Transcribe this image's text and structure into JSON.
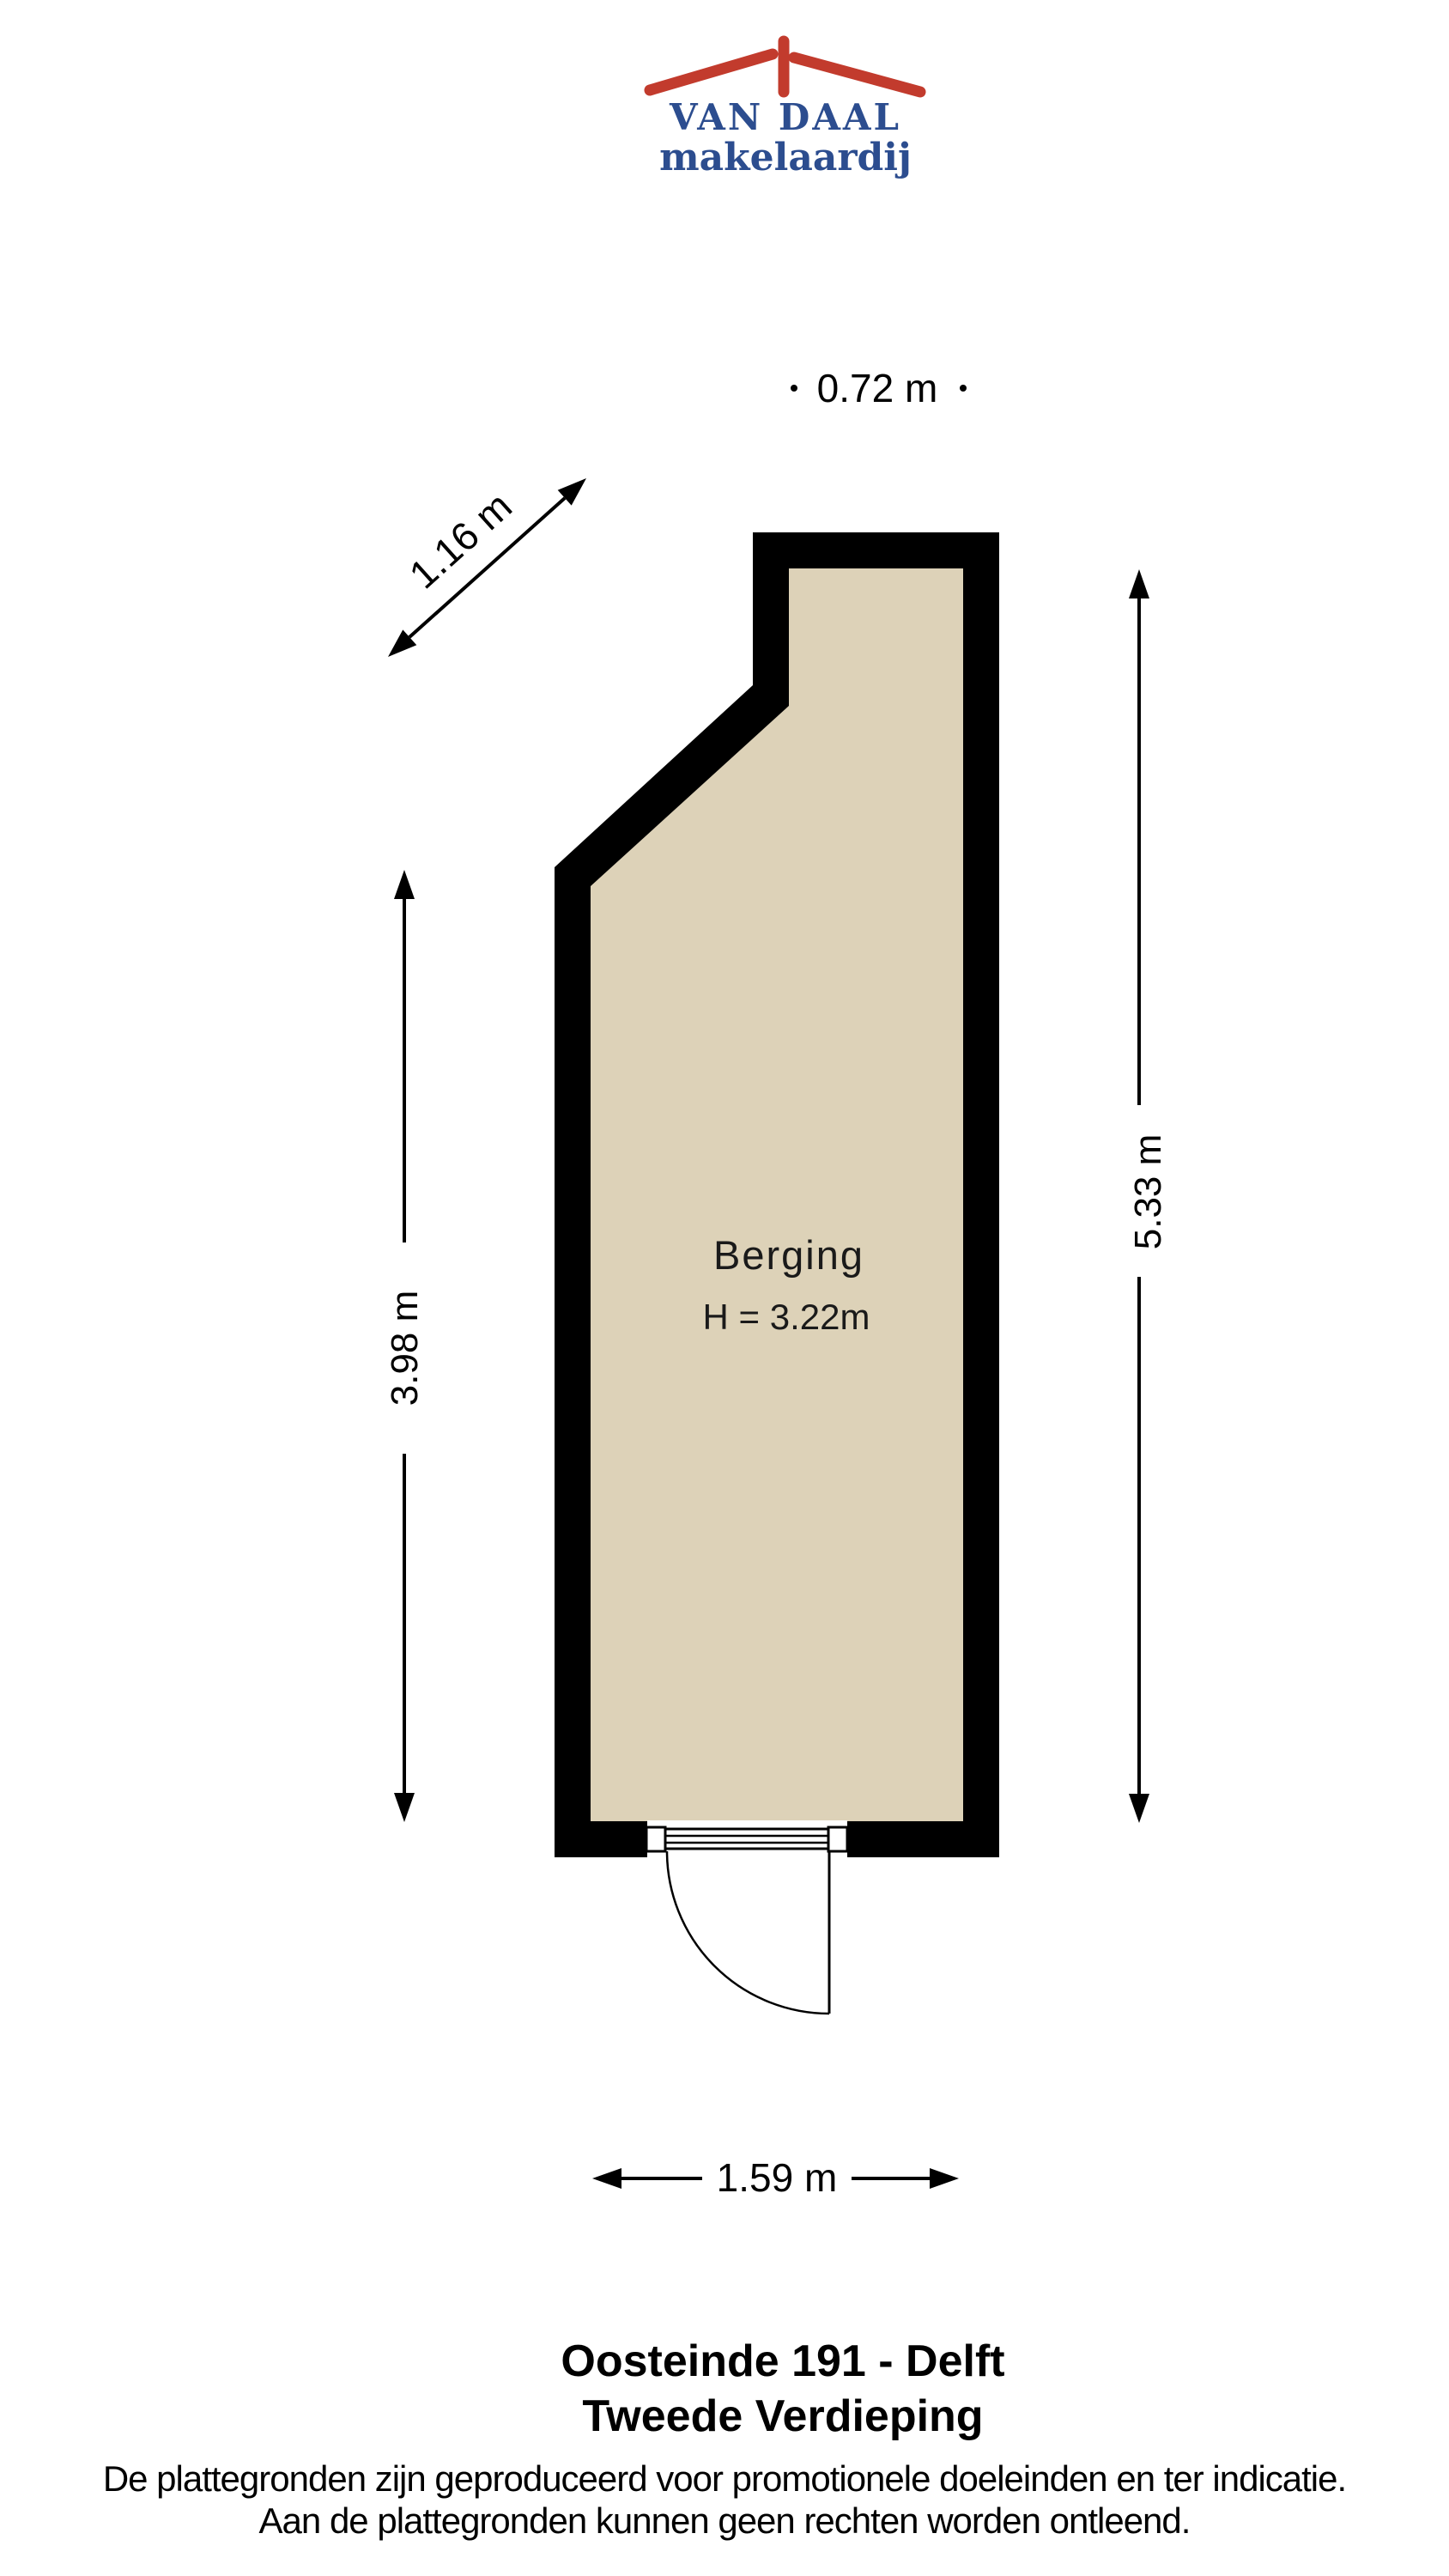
{
  "logo": {
    "brand": "VAN DAAL",
    "subtitle": "makelaardij",
    "roof_color": "#c23b2d",
    "text_color": "#2c4d8f"
  },
  "plan": {
    "room": {
      "name": "Berging",
      "height_label": "H = 3.22m"
    },
    "dims": {
      "top": "0.72 m",
      "diagonal": "1.16 m",
      "left": "3.98 m",
      "right": "5.33 m",
      "bottom": "1.59 m"
    },
    "colors": {
      "wall": "#000000",
      "floor": "#ddd2b8"
    }
  },
  "footer": {
    "address": "Oosteinde 191 - Delft",
    "floor": "Tweede Verdieping",
    "disclaimer1": "De plattegronden zijn geproduceerd voor promotionele doeleinden en ter indicatie.",
    "disclaimer2": "Aan de plattegronden kunnen geen rechten worden ontleend."
  }
}
